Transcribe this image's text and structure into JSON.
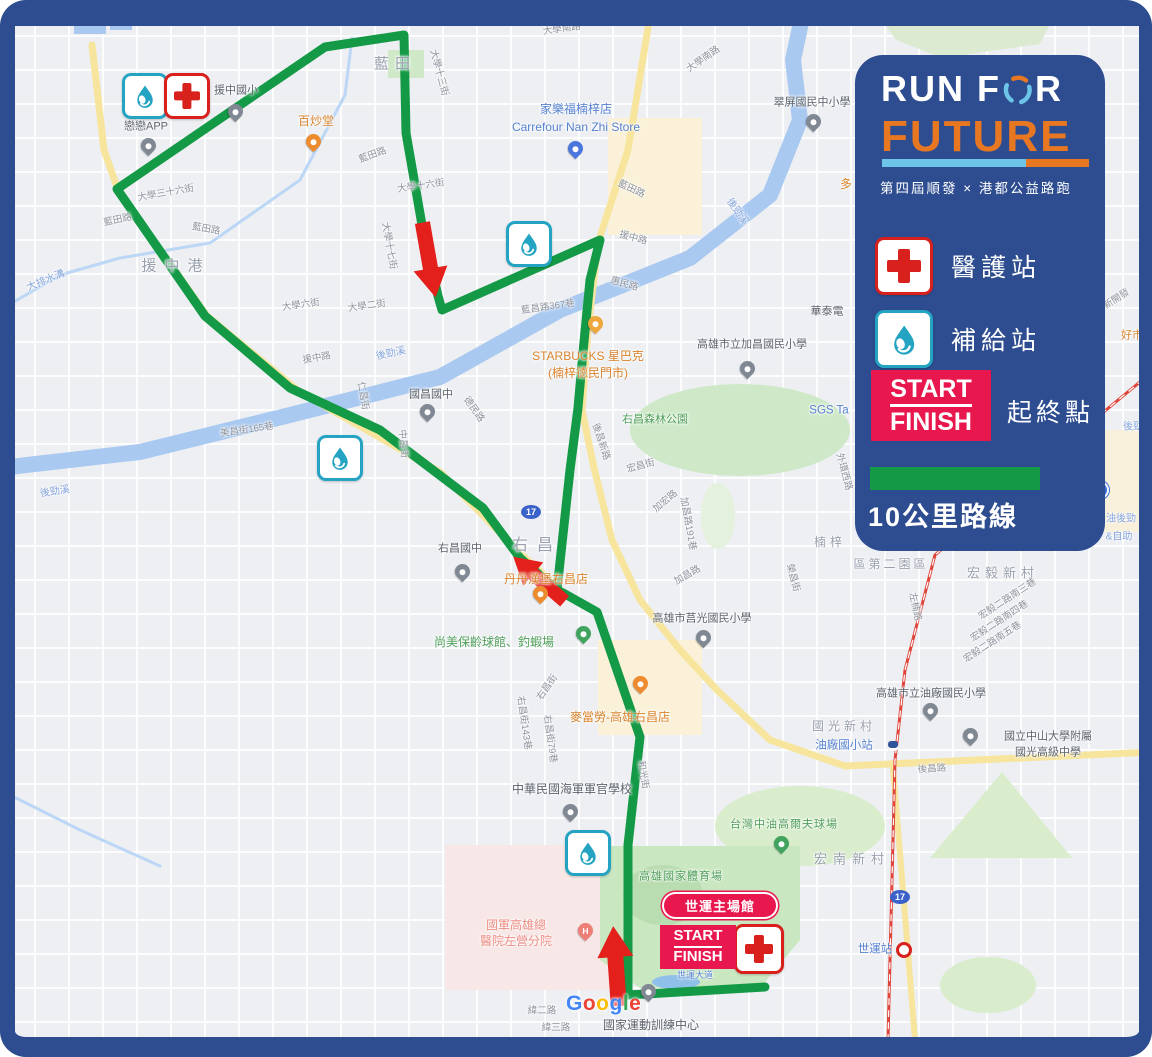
{
  "colors": {
    "navy": "#2e4d90",
    "orange": "#e87722",
    "sky_blue": "#6cc5e9",
    "route_green": "#149a46",
    "crimson": "#e8174e",
    "arrow_red": "#e3201b",
    "cross_red": "#d8201d",
    "water_teal": "#25a3c2"
  },
  "legend": {
    "title_prefix": "RUN F",
    "title_suffix": "R",
    "title_line2": "FUTURE",
    "subtitle": "第四屆順發 × 港都公益路跑",
    "items": {
      "medical": "醫護站",
      "supply": "補給站",
      "start": "START",
      "finish": "FINISH",
      "start_finish_label": "起終點",
      "route_label": "10公里路線"
    }
  },
  "start_finish_marker": {
    "start": "START",
    "finish": "FINISH",
    "venue": "世運主場館"
  },
  "google": {
    "letters": [
      {
        "ch": "G",
        "c": "#4285F4"
      },
      {
        "ch": "o",
        "c": "#EA4335"
      },
      {
        "ch": "o",
        "c": "#FBBC05"
      },
      {
        "ch": "g",
        "c": "#4285F4"
      },
      {
        "ch": "l",
        "c": "#34A853"
      },
      {
        "ch": "e",
        "c": "#EA4335"
      }
    ]
  },
  "map": {
    "labels": [
      {
        "t": "藍田",
        "x": 395,
        "y": 64,
        "c": "area",
        "s": 15,
        "ls": 6
      },
      {
        "t": "援中港",
        "x": 176,
        "y": 266,
        "c": "area",
        "s": 15,
        "ls": 8
      },
      {
        "t": "右昌",
        "x": 537,
        "y": 546,
        "c": "area",
        "s": 16,
        "ls": 9
      },
      {
        "t": "宏毅新村",
        "x": 1003,
        "y": 574,
        "c": "area",
        "s": 13,
        "ls": 5
      },
      {
        "t": "宏南新村",
        "x": 852,
        "y": 860,
        "c": "area",
        "s": 13,
        "ls": 6
      },
      {
        "t": "國光新村",
        "x": 844,
        "y": 727,
        "c": "area",
        "s": 12,
        "ls": 4
      },
      {
        "t": "楠梓",
        "x": 830,
        "y": 543,
        "c": "area",
        "s": 12,
        "ls": 4
      },
      {
        "t": "區第二園區",
        "x": 891,
        "y": 565,
        "c": "area",
        "s": 12,
        "ls": 3
      },
      {
        "t": "戀戀APP",
        "x": 146,
        "y": 127,
        "c": "poi"
      },
      {
        "t": "援中國小",
        "x": 236,
        "y": 91,
        "c": "poi"
      },
      {
        "t": "國昌國中",
        "x": 431,
        "y": 395,
        "c": "poi"
      },
      {
        "t": "右昌國中",
        "x": 460,
        "y": 549,
        "c": "poi"
      },
      {
        "t": "華泰電",
        "x": 827,
        "y": 312,
        "c": "poi"
      },
      {
        "t": "高雄市立加昌國民小學",
        "x": 752,
        "y": 345,
        "c": "poi"
      },
      {
        "t": "高雄市莒光國民小學",
        "x": 702,
        "y": 619,
        "c": "poi"
      },
      {
        "t": "高雄市立油廠國民小學",
        "x": 931,
        "y": 694,
        "c": "poi"
      },
      {
        "t": "國立中山大學附屬",
        "x": 1048,
        "y": 737,
        "c": "poi"
      },
      {
        "t": "國光高級中學",
        "x": 1048,
        "y": 753,
        "c": "poi"
      },
      {
        "t": "中華民國海軍軍官學校",
        "x": 572,
        "y": 790,
        "c": "poi",
        "s": 12
      },
      {
        "t": "國家運動訓練中心",
        "x": 651,
        "y": 1026,
        "c": "poi",
        "s": 12
      },
      {
        "t": "翠屏國民中小學",
        "x": 812,
        "y": 103,
        "c": "poi"
      },
      {
        "t": "國軍高雄總",
        "x": 516,
        "y": 926,
        "c": "hosp"
      },
      {
        "t": "醫院左營分院",
        "x": 516,
        "y": 942,
        "c": "hosp"
      },
      {
        "t": "百炒堂",
        "x": 316,
        "y": 122,
        "c": "food"
      },
      {
        "t": "STARBUCKS 星巴克",
        "x": 588,
        "y": 357,
        "c": "food"
      },
      {
        "t": "(楠梓德民門市)",
        "x": 588,
        "y": 374,
        "c": "food"
      },
      {
        "t": "丹丹漢堡右昌店",
        "x": 546,
        "y": 580,
        "c": "food"
      },
      {
        "t": "麥當勞-高雄右昌店",
        "x": 620,
        "y": 718,
        "c": "food"
      },
      {
        "t": "多",
        "x": 846,
        "y": 185,
        "c": "food"
      },
      {
        "t": "好市",
        "x": 1132,
        "y": 336,
        "c": "food",
        "s": 11
      },
      {
        "t": "尚美保齡球館、釣蝦場",
        "x": 494,
        "y": 643,
        "c": "park",
        "s": 12
      },
      {
        "t": "右昌森林公園",
        "x": 655,
        "y": 420,
        "c": "park"
      },
      {
        "t": "高雄國家體育場",
        "x": 681,
        "y": 877,
        "c": "park",
        "ls": 1
      },
      {
        "t": "台灣中油高爾夫球場",
        "x": 784,
        "y": 825,
        "c": "park",
        "ls": 1
      },
      {
        "t": "家樂福楠梓店",
        "x": 576,
        "y": 110,
        "c": "shop",
        "s": 12
      },
      {
        "t": "Carrefour Nan Zhi Store",
        "x": 576,
        "y": 128,
        "c": "shop",
        "s": 12
      },
      {
        "t": "SGS Ta",
        "x": 829,
        "y": 411,
        "c": "shop"
      },
      {
        "t": "油廠國小站",
        "x": 844,
        "y": 746,
        "c": "shop"
      },
      {
        "t": "世運站",
        "x": 875,
        "y": 950,
        "c": "shop"
      },
      {
        "t": "世運大道",
        "x": 695,
        "y": 975,
        "c": "shop",
        "s": 9
      },
      {
        "t": "大排水溝",
        "x": 46,
        "y": 281,
        "c": "water",
        "r": -22
      },
      {
        "t": "後勁溪",
        "x": 55,
        "y": 492,
        "c": "water",
        "r": -8
      },
      {
        "t": "後勁溪",
        "x": 391,
        "y": 354,
        "c": "water",
        "r": -12
      },
      {
        "t": "後勁溪",
        "x": 737,
        "y": 212,
        "c": "water",
        "r": 55
      },
      {
        "t": "後勁",
        "x": 1133,
        "y": 427,
        "c": "water"
      },
      {
        "t": "油後勁",
        "x": 1121,
        "y": 519,
        "c": "water"
      },
      {
        "t": "&自助",
        "x": 1119,
        "y": 537,
        "c": "water"
      },
      {
        "t": "大學南路",
        "x": 562,
        "y": 30,
        "c": "street",
        "r": -8
      },
      {
        "t": "大學南路",
        "x": 704,
        "y": 60,
        "c": "street",
        "r": -35
      },
      {
        "t": "藍田路",
        "x": 118,
        "y": 221,
        "c": "street",
        "r": -12
      },
      {
        "t": "藍田路",
        "x": 206,
        "y": 230,
        "c": "street",
        "r": 10
      },
      {
        "t": "藍田路",
        "x": 373,
        "y": 156,
        "c": "street",
        "r": -20
      },
      {
        "t": "藍田路",
        "x": 631,
        "y": 190,
        "c": "street",
        "r": 25
      },
      {
        "t": "大學三十六街",
        "x": 166,
        "y": 194,
        "c": "street",
        "r": -10
      },
      {
        "t": "大學十六街",
        "x": 421,
        "y": 187,
        "c": "street",
        "r": -8
      },
      {
        "t": "大學十三街",
        "x": 438,
        "y": 73,
        "c": "street",
        "r": 75
      },
      {
        "t": "大學十七街",
        "x": 388,
        "y": 246,
        "c": "street",
        "r": 80
      },
      {
        "t": "大學六街",
        "x": 301,
        "y": 306,
        "c": "street",
        "r": -8
      },
      {
        "t": "大學二街",
        "x": 367,
        "y": 307,
        "c": "street",
        "r": -8
      },
      {
        "t": "援中路",
        "x": 317,
        "y": 359,
        "c": "street",
        "r": -10
      },
      {
        "t": "援中路",
        "x": 633,
        "y": 239,
        "c": "street",
        "r": 15
      },
      {
        "t": "惠民路",
        "x": 624,
        "y": 285,
        "c": "street",
        "r": 15
      },
      {
        "t": "德民路",
        "x": 473,
        "y": 410,
        "c": "street",
        "r": 55
      },
      {
        "t": "中昌街",
        "x": 402,
        "y": 444,
        "c": "street",
        "r": 85
      },
      {
        "t": "北昌街",
        "x": 336,
        "y": 449,
        "c": "street",
        "r": 85
      },
      {
        "t": "仁昌街",
        "x": 362,
        "y": 396,
        "c": "street",
        "r": 80
      },
      {
        "t": "美昌街165巷",
        "x": 247,
        "y": 431,
        "c": "street",
        "r": -8
      },
      {
        "t": "藍昌路367巷",
        "x": 548,
        "y": 308,
        "c": "street",
        "r": -8
      },
      {
        "t": "後昌新路",
        "x": 600,
        "y": 442,
        "c": "street",
        "r": 72
      },
      {
        "t": "宏昌街",
        "x": 641,
        "y": 467,
        "c": "street",
        "r": -15
      },
      {
        "t": "加宏路",
        "x": 666,
        "y": 502,
        "c": "street",
        "r": -40
      },
      {
        "t": "加昌路191巷",
        "x": 687,
        "y": 524,
        "c": "street",
        "r": 80
      },
      {
        "t": "加昌路",
        "x": 688,
        "y": 576,
        "c": "street",
        "r": -30
      },
      {
        "t": "右昌街",
        "x": 548,
        "y": 688,
        "c": "street",
        "r": -55
      },
      {
        "t": "右昌街143巷",
        "x": 523,
        "y": 723,
        "c": "street",
        "r": 82
      },
      {
        "t": "右昌街79巷",
        "x": 549,
        "y": 739,
        "c": "street",
        "r": 82
      },
      {
        "t": "和光街",
        "x": 642,
        "y": 775,
        "c": "street",
        "r": 80
      },
      {
        "t": "後昌路",
        "x": 932,
        "y": 770,
        "c": "street",
        "r": -4
      },
      {
        "t": "左楠路",
        "x": 914,
        "y": 607,
        "c": "street",
        "r": 78
      },
      {
        "t": "宏毅二路南三巷",
        "x": 1008,
        "y": 600,
        "c": "street",
        "r": -33
      },
      {
        "t": "宏毅二路南四巷",
        "x": 1000,
        "y": 622,
        "c": "street",
        "r": -33
      },
      {
        "t": "宏毅二路南五巷",
        "x": 993,
        "y": 643,
        "c": "street",
        "r": -33
      },
      {
        "t": "緯二路",
        "x": 542,
        "y": 1012,
        "c": "street"
      },
      {
        "t": "緯三路",
        "x": 556,
        "y": 1029,
        "c": "street"
      },
      {
        "t": "榮昌街",
        "x": 792,
        "y": 578,
        "c": "street",
        "r": 75
      },
      {
        "t": "外環西路",
        "x": 843,
        "y": 472,
        "c": "street",
        "r": 75
      },
      {
        "t": "新開發",
        "x": 1117,
        "y": 300,
        "c": "street",
        "r": -33
      }
    ],
    "pins": [
      {
        "x": 235,
        "y": 118,
        "t": "school"
      },
      {
        "x": 148,
        "y": 152,
        "t": "generic"
      },
      {
        "x": 427,
        "y": 418,
        "t": "school"
      },
      {
        "x": 462,
        "y": 578,
        "t": "school"
      },
      {
        "x": 747,
        "y": 375,
        "t": "school"
      },
      {
        "x": 703,
        "y": 644,
        "t": "school"
      },
      {
        "x": 930,
        "y": 717,
        "t": "school"
      },
      {
        "x": 970,
        "y": 742,
        "t": "school"
      },
      {
        "x": 570,
        "y": 818,
        "t": "school"
      },
      {
        "x": 813,
        "y": 128,
        "t": "school"
      },
      {
        "x": 648,
        "y": 998,
        "t": "generic"
      },
      {
        "x": 313,
        "y": 148,
        "t": "food"
      },
      {
        "x": 540,
        "y": 600,
        "t": "food"
      },
      {
        "x": 640,
        "y": 690,
        "t": "food"
      },
      {
        "x": 595,
        "y": 330,
        "t": "coffee"
      },
      {
        "x": 575,
        "y": 155,
        "t": "cart"
      },
      {
        "x": 583,
        "y": 640,
        "t": "leisure"
      },
      {
        "x": 781,
        "y": 850,
        "t": "golf"
      },
      {
        "x": 585,
        "y": 937,
        "t": "hospital"
      }
    ],
    "badges": [
      {
        "x": 142,
        "y": 93,
        "k": "water",
        "sz": 40
      },
      {
        "x": 184,
        "y": 93,
        "k": "medical",
        "sz": 40
      },
      {
        "x": 526,
        "y": 241,
        "k": "water",
        "sz": 40
      },
      {
        "x": 337,
        "y": 455,
        "k": "water",
        "sz": 40
      },
      {
        "x": 585,
        "y": 850,
        "k": "water",
        "sz": 40
      },
      {
        "x": 756,
        "y": 946,
        "k": "medical",
        "sz": 44
      }
    ],
    "shields": [
      {
        "x": 531,
        "y": 512,
        "t": "17"
      },
      {
        "x": 900,
        "y": 897,
        "t": "17"
      }
    ],
    "transit": [
      {
        "x": 893,
        "y": 746,
        "k": "train"
      },
      {
        "x": 904,
        "y": 950,
        "k": "metro"
      },
      {
        "x": 1100,
        "y": 490,
        "k": "metro-blue"
      }
    ],
    "paths": [
      {
        "kind": "polygon",
        "name": "hospital-district",
        "pts": "445,845 610,845 610,990 445,990",
        "fill": "#f7e7e6"
      },
      {
        "kind": "polygon",
        "name": "commercial-block",
        "pts": "608,118 702,118 702,235 608,235",
        "fill": "#faf1d8"
      },
      {
        "kind": "polygon",
        "name": "commercial-block",
        "pts": "1075,430 1152,430 1152,532 1075,532",
        "fill": "#f8f0da"
      },
      {
        "kind": "polygon",
        "name": "commercial-block",
        "pts": "598,640 702,640 702,735 598,735",
        "fill": "#faf1d8"
      },
      {
        "kind": "polygon",
        "name": "hill-park",
        "pts": "868,0 1062,0 1040,44 942,58 896,40",
        "fill": "#dcead2"
      },
      {
        "kind": "ellipse",
        "name": "youchang-forest-park",
        "cx": 740,
        "cy": 430,
        "rx": 110,
        "ry": 46,
        "fill": "#cfe9c8"
      },
      {
        "kind": "polygon",
        "name": "small-park",
        "pts": "388,50 424,50 424,78 388,78",
        "fill": "#cfe9c8"
      },
      {
        "kind": "ellipse",
        "name": "trail-park",
        "cx": 718,
        "cy": 516,
        "rx": 17,
        "ry": 33,
        "fill": "#e4f1dd"
      },
      {
        "kind": "ellipse",
        "name": "golf-course",
        "cx": 800,
        "cy": 826,
        "rx": 85,
        "ry": 40,
        "fill": "#d9edcd"
      },
      {
        "kind": "polygon",
        "name": "green-area",
        "pts": "1002,772 1072,858 930,858",
        "fill": "#d9edcd"
      },
      {
        "kind": "ellipse",
        "name": "green-area",
        "cx": 988,
        "cy": 985,
        "rx": 48,
        "ry": 28,
        "fill": "#d9edcd"
      },
      {
        "kind": "polygon",
        "name": "stadium-park",
        "pts": "600,846 800,846 800,940 760,988 640,988 600,960",
        "fill": "#c9e7c0"
      },
      {
        "kind": "ellipse",
        "name": "stadium",
        "cx": 663,
        "cy": 895,
        "rx": 40,
        "ry": 30,
        "fill": "#b9dcb0"
      },
      {
        "kind": "polyline",
        "name": "houjin-river",
        "pts": "0,468 140,452 290,415 440,377 560,310 690,258 770,195 800,120 793,60 802,18",
        "stroke": "#a9c9f1",
        "w": 16
      },
      {
        "kind": "polyline",
        "name": "drain-canal",
        "pts": "0,310 60,275 120,258 210,243 300,180 345,95 352,38",
        "stroke": "#bcd7f5",
        "w": 3
      },
      {
        "kind": "polyline",
        "name": "canal",
        "pts": "0,790 80,830 160,866",
        "stroke": "#bcd7f5",
        "w": 3
      },
      {
        "kind": "polygon",
        "name": "pond",
        "pts": "74,6 106,6 106,34 74,34",
        "fill": "#a9c9f1"
      },
      {
        "kind": "polygon",
        "name": "pond",
        "pts": "110,12 132,12 132,30 110,30",
        "fill": "#a9c9f1"
      },
      {
        "kind": "ellipse",
        "name": "stadium-pond",
        "cx": 676,
        "cy": 982,
        "rx": 24,
        "ry": 7,
        "fill": "#8fc0ea"
      },
      {
        "kind": "polyline",
        "name": "major-road",
        "pts": "92,45 104,150 118,190 207,316 300,392 440,472 523,556 570,598",
        "stroke": "#f7e59d",
        "w": 7
      },
      {
        "kind": "polyline",
        "name": "major-road",
        "pts": "648,28 628,150 598,243 588,330 582,410 594,468 612,540 640,600 680,650 717,690 770,740 845,766",
        "stroke": "#f7e59d",
        "w": 7
      },
      {
        "kind": "polyline",
        "name": "houchang-road",
        "pts": "845,766 1152,752",
        "stroke": "#f7e59d",
        "w": 7
      },
      {
        "kind": "polyline",
        "name": "highway-17",
        "pts": "893,768 903,890 915,1040",
        "stroke": "#f7e59d",
        "w": 6
      },
      {
        "kind": "polyline",
        "name": "railway",
        "pts": "1152,372 1100,415 935,555 905,670 895,760 888,1040",
        "stroke": "#e0453a",
        "w": 3
      },
      {
        "kind": "polyline",
        "name": "railway-dash",
        "pts": "1152,372 1100,415 935,555 905,670 895,760 888,1040",
        "stroke": "#ffffff",
        "w": 1.2,
        "dash": "6,6"
      },
      {
        "kind": "polyline",
        "name": "route-10k-loop",
        "pts": "117,189 325,47 404,35 406,133 422,225 438,296 442,310 600,240 590,280 583,352 578,408 570,470 561,553 557,590 520,558 483,508 380,430 290,388 205,316 117,189",
        "stroke": "#149a46",
        "w": 9
      },
      {
        "kind": "polyline",
        "name": "route-10k-spur",
        "pts": "557,590 565,594 597,612 640,737 633,800 628,845 628,995 765,987",
        "stroke": "#149a46",
        "w": 9
      }
    ],
    "arrows": [
      {
        "x": 429,
        "y": 260,
        "r": 170,
        "s": 0.95
      },
      {
        "x": 539,
        "y": 579,
        "r": -49,
        "s": 0.85
      },
      {
        "x": 616,
        "y": 966,
        "r": -4,
        "s": 1
      }
    ]
  }
}
